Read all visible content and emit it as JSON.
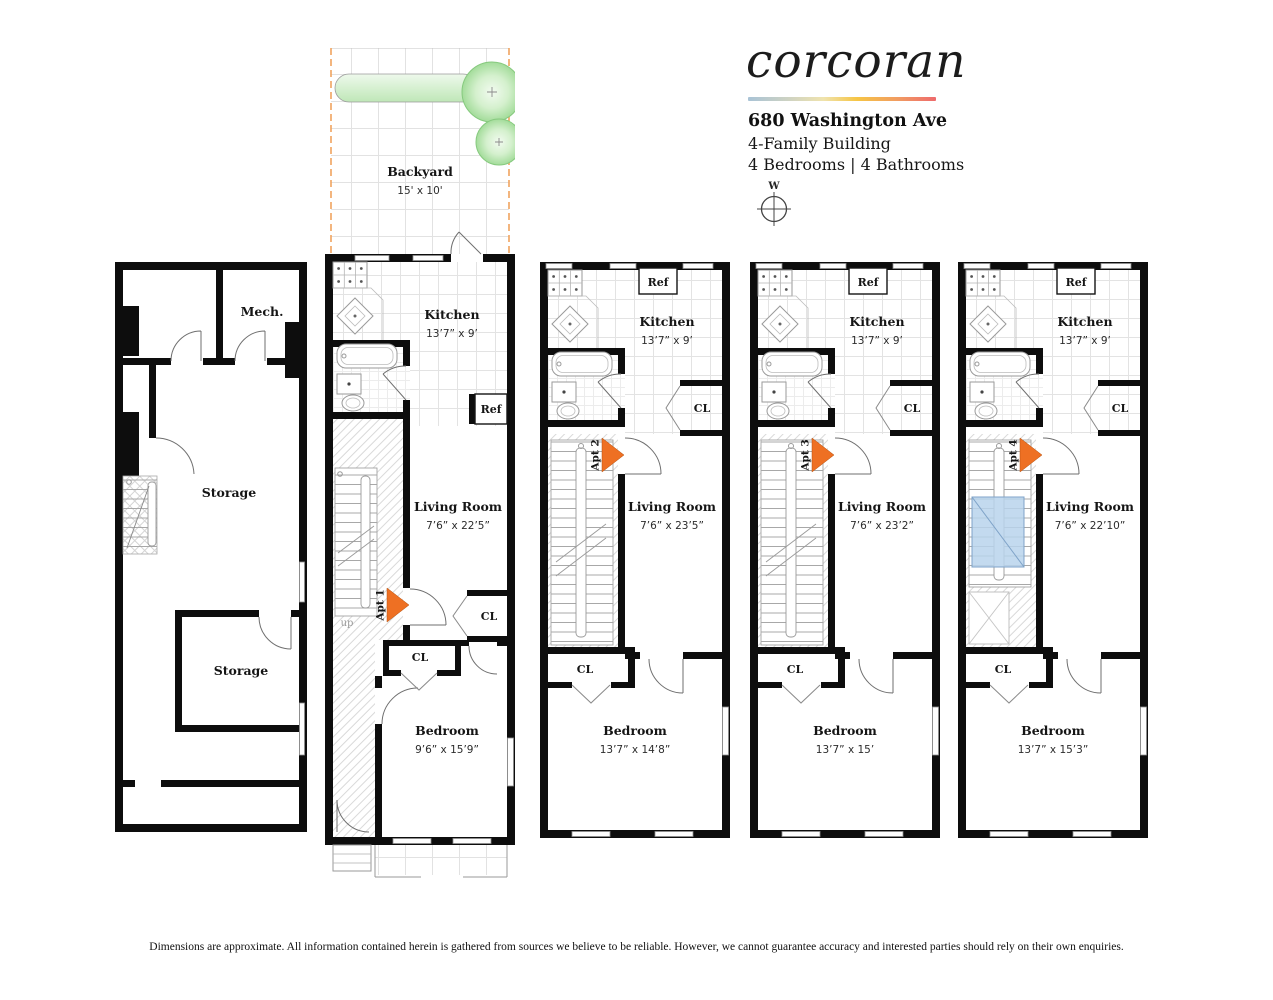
{
  "header": {
    "logo": "corcoran",
    "address": "680 Washington Ave",
    "building_type": "4-Family Building",
    "rooms_summary": "4 Bedrooms | 4 Bathrooms",
    "compass_direction": "W",
    "entry_marker_color": "#ee7023",
    "accent_gradient": [
      "#a9c3d6",
      "#efe3ae",
      "#f6c545",
      "#ee6a6c"
    ]
  },
  "backyard": {
    "name": "Backyard",
    "dims": "15' x 10'"
  },
  "cellar": {
    "mech": "Mech.",
    "storage_upper": "Storage",
    "storage_lower": "Storage"
  },
  "labels": {
    "ref": "Ref",
    "closet": "CL",
    "up": "up"
  },
  "units": [
    {
      "entry": "Apt 1",
      "kitchen_name": "Kitchen",
      "kitchen_dims": "13’7” x 9’",
      "living_name": "Living Room",
      "living_dims": "7’6” x 22’5”",
      "bedroom_name": "Bedroom",
      "bedroom_dims": "9’6” x 15’9”"
    },
    {
      "entry": "Apt 2",
      "kitchen_name": "Kitchen",
      "kitchen_dims": "13’7” x 9’",
      "living_name": "Living Room",
      "living_dims": "7’6” x 23’5”",
      "bedroom_name": "Bedroom",
      "bedroom_dims": "13’7” x 14’8”"
    },
    {
      "entry": "Apt 3",
      "kitchen_name": "Kitchen",
      "kitchen_dims": "13’7” x 9’",
      "living_name": "Living Room",
      "living_dims": "7’6” x 23’2”",
      "bedroom_name": "Bedroom",
      "bedroom_dims": "13’7” x 15’"
    },
    {
      "entry": "Apt 4",
      "kitchen_name": "Kitchen",
      "kitchen_dims": "13’7” x 9’",
      "living_name": "Living Room",
      "living_dims": "7’6” x 22’10”",
      "bedroom_name": "Bedroom",
      "bedroom_dims": "13’7” x 15’3”"
    }
  ],
  "disclaimer": "Dimensions are approximate. All information contained herein is gathered from sources we believe to be reliable. However, we cannot guarantee accuracy and interested parties should rely on their own enquiries."
}
